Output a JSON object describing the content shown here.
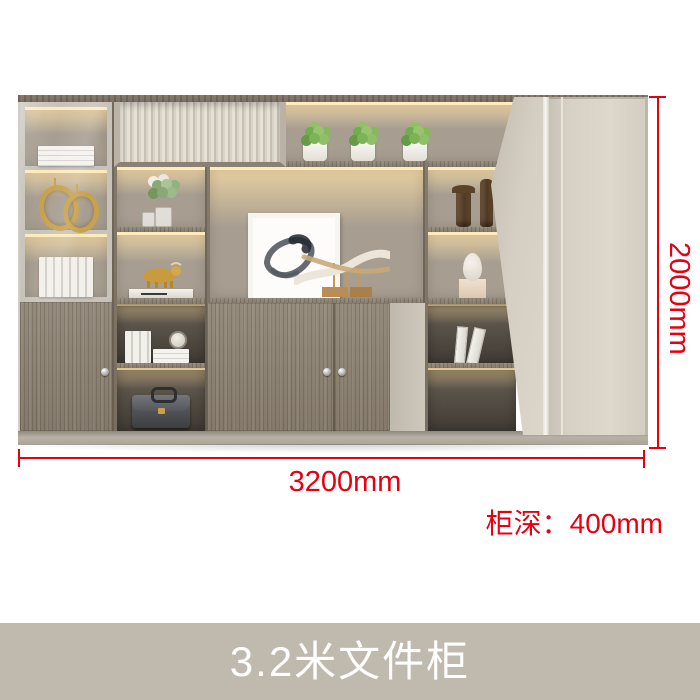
{
  "product": {
    "name": "office-filing-cabinet",
    "decor_items": [
      "white-books",
      "gold-ring-ornaments",
      "glass-vase-with-flowers",
      "gold-bull-figurine",
      "books-with-clock",
      "leather-briefcase",
      "succulent-plant-pots",
      "framed-ink-painting",
      "horn-sculpture",
      "bronze-vases",
      "stone-head-sculpture",
      "leaning-books"
    ]
  },
  "dimensions": {
    "width": "3200mm",
    "height": "2000mm",
    "depth": "柜深：400mm"
  },
  "caption": "3.2米文件柜",
  "colors": {
    "accent_red": "#e60012",
    "caption_bar": "#c0b9ae",
    "caption_text": "#ffffff",
    "wood": "#8d8273",
    "cream_panel": "#d9d3c7",
    "interior_taupe": "#a79e91",
    "led_glow": "#ffeabc"
  }
}
